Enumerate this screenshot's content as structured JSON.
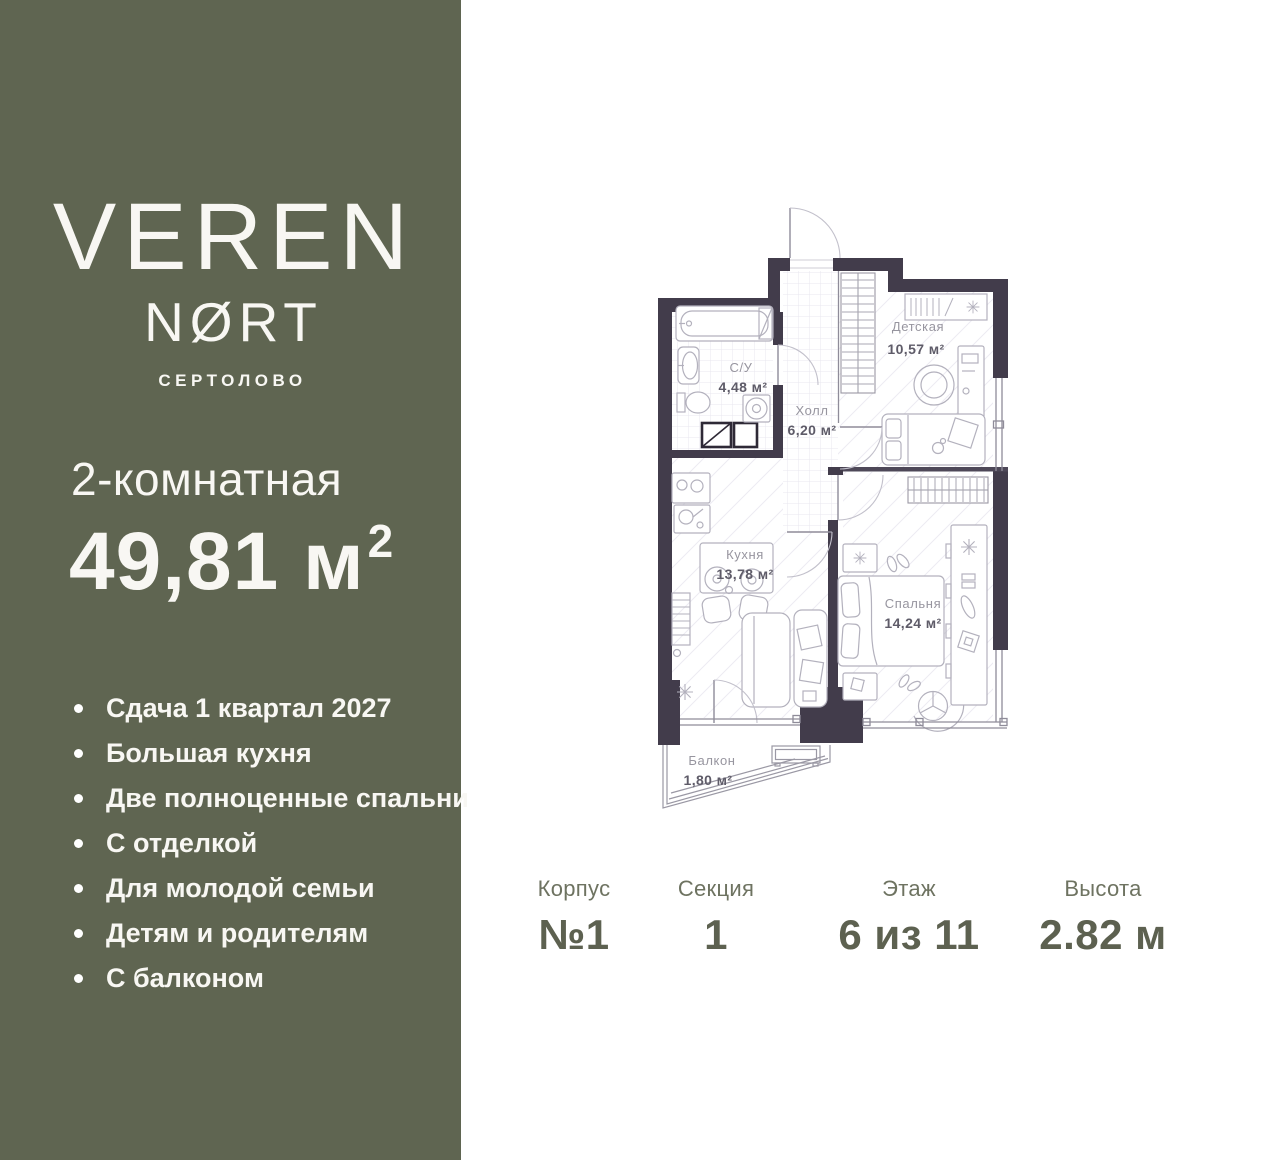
{
  "colors": {
    "sidebar_bg": "#5f6551",
    "wall": "#423c4b",
    "stats_value": "#5d6150",
    "sidebar_text": "#f8f7f3"
  },
  "sidebar": {
    "brand": {
      "line1": "VEREN",
      "line2": "NØRT",
      "location": "СЕРТОЛОВО"
    },
    "apartment": {
      "type": "2-комнатная",
      "area": "49,81 м",
      "area_sup": "2"
    },
    "features": [
      "Сдача 1 квартал 2027",
      "Большая кухня",
      "Две полноценные спальни",
      "С отделкой",
      "Для молодой семьи",
      "Детям и родителям",
      "С балконом"
    ]
  },
  "floorplan": {
    "rooms": [
      {
        "name": "С/У",
        "area": "4,48 м²"
      },
      {
        "name": "Холл",
        "area": "6,20 м²"
      },
      {
        "name": "Детская",
        "area": "10,57 м²"
      },
      {
        "name": "Кухня",
        "area": "13,78 м²"
      },
      {
        "name": "Спальня",
        "area": "14,24 м²"
      },
      {
        "name": "Балкон",
        "area": "1,80 м²"
      }
    ]
  },
  "stats": {
    "items": [
      {
        "label": "Корпус",
        "value": "№1"
      },
      {
        "label": "Секция",
        "value": "1"
      },
      {
        "label": "Этаж",
        "value": "6 из 11"
      },
      {
        "label": "Высота",
        "value": "2.82 м"
      }
    ]
  }
}
